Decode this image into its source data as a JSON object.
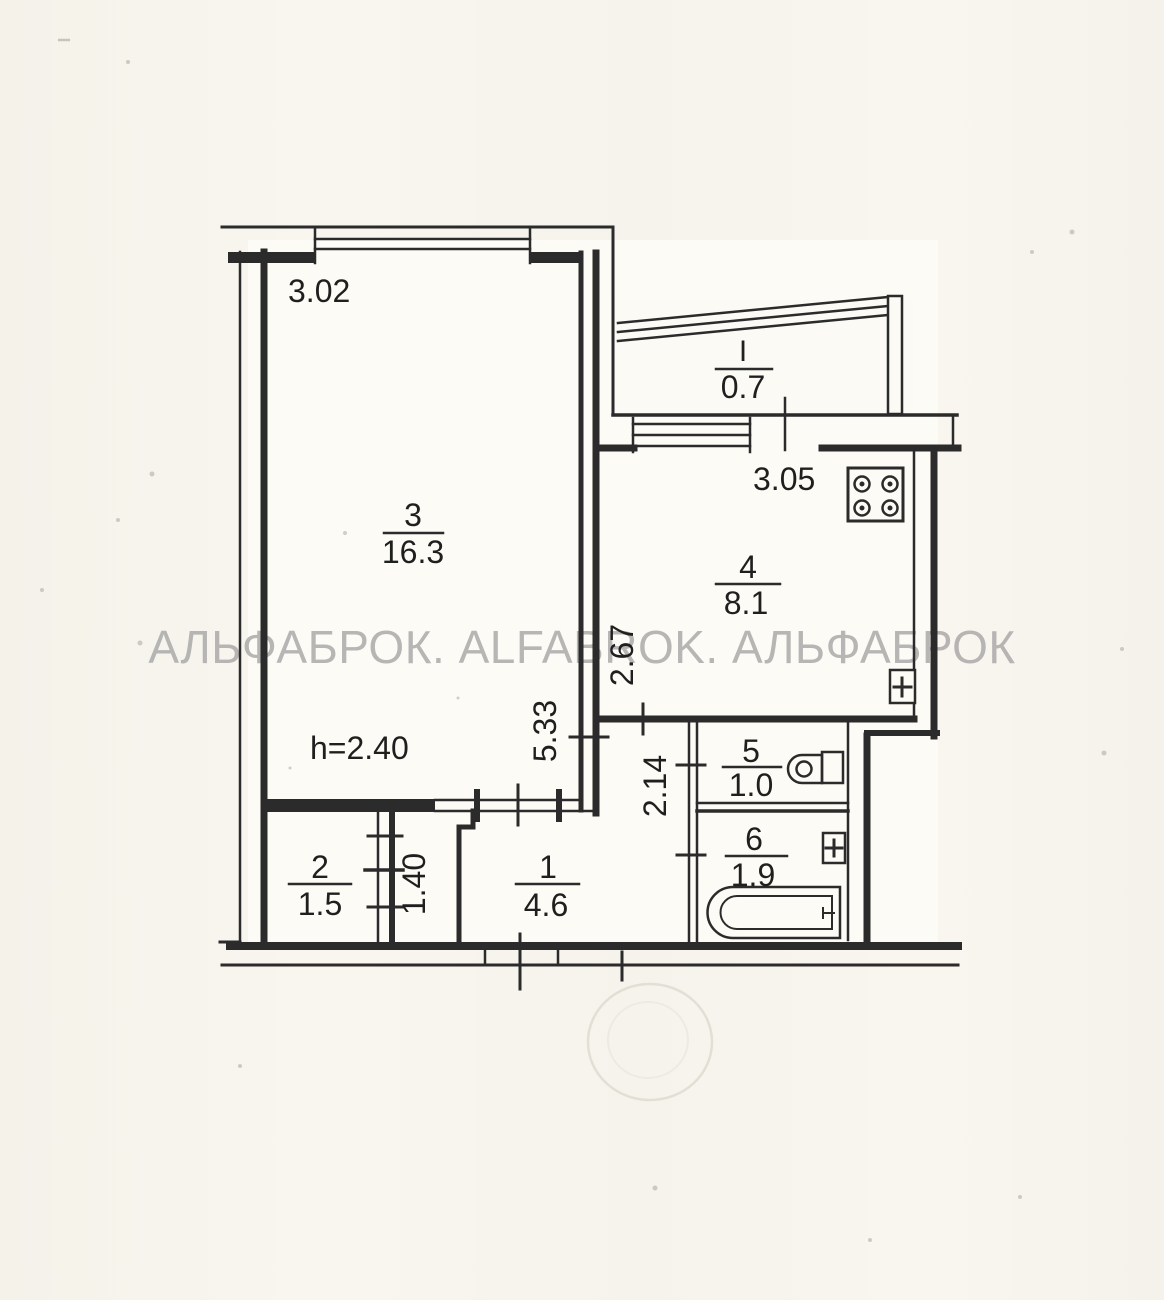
{
  "plan": {
    "watermark": "АЛЬФАБРОК. ALFABROK. АЛЬФАБРОК",
    "ceiling_height": "h=2.40",
    "rooms": [
      {
        "number": "3",
        "area": "16.3"
      },
      {
        "number": "4",
        "area": "8.1"
      },
      {
        "number": "5",
        "area": "1.0"
      },
      {
        "number": "6",
        "area": "1.9"
      },
      {
        "number": "1",
        "area": "4.6"
      },
      {
        "number": "2",
        "area": "1.5"
      },
      {
        "number": "I",
        "area": "0.7"
      }
    ],
    "dimensions": {
      "room3_width": "3.02",
      "room3_depth": "5.33",
      "room4_width": "3.05",
      "room4_depth": "2.67",
      "hall_depth": "2.14",
      "closet_depth": "1.40"
    },
    "fixtures": [
      "stove-icon",
      "sink-icon",
      "toilet-icon",
      "bathtub-icon"
    ],
    "colors": {
      "ink": "#2b2b2b",
      "paper": "#f6f4ec",
      "room_fill": "#fcfbf6",
      "watermark": "#a6a6a6",
      "stamp": "#d6d4c6"
    }
  }
}
